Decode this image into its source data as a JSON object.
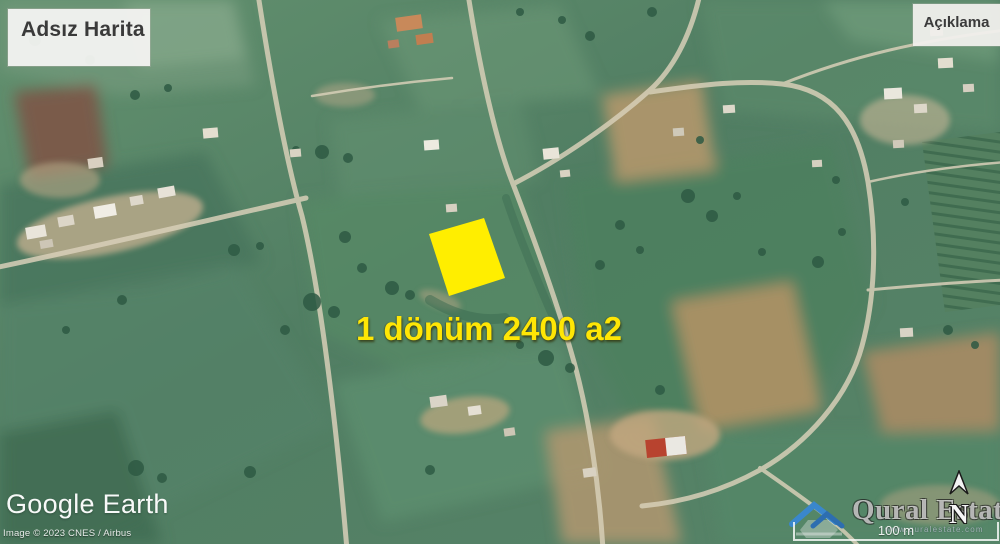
{
  "window": {
    "width": 1000,
    "height": 544
  },
  "map": {
    "title_box": {
      "label": "Adsız Harita"
    },
    "legend_box": {
      "label": "Açıklama"
    },
    "parcel": {
      "label": "1 dönüm 2400 a2",
      "highlight_color": "#ffee00",
      "label_color": "#ffe605"
    },
    "scale_bar": {
      "label": "100 m"
    },
    "compass": {
      "label": "N"
    },
    "logo": {
      "label": "Google Earth"
    },
    "attribution": {
      "label": "Image © 2023 CNES / Airbus"
    },
    "watermark": {
      "brand": "Qural Estate",
      "url": "www.quralestate.com"
    }
  },
  "colors": {
    "field_green": "#57806a",
    "road": "#d8cfb8",
    "dirt_tan": "#c0ae8d",
    "plowed_brown": "#7b5949"
  }
}
